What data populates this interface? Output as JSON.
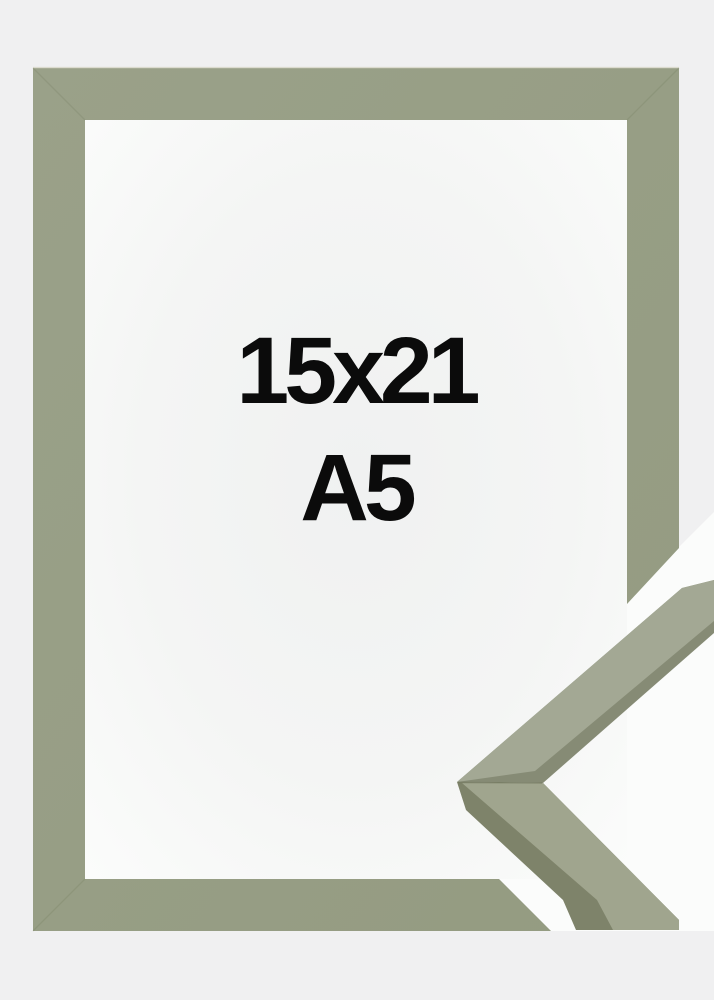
{
  "size_label": {
    "line1": "15x21",
    "line2": "A5"
  },
  "colors": {
    "background": "#f0f0f1",
    "frame_light": "#9aa189",
    "frame_dark": "#949b81",
    "frame_edge_highlight": "#d8d7c9",
    "frame_seam": "#6f7558",
    "window_center": "#f0f1f1",
    "window_mid": "#f4f5f4",
    "window_edge": "#fbfcfb",
    "cutout_white": "#fbfcfb",
    "detail_face_upper": "#a3a894",
    "detail_face_lower": "#a0a58e",
    "detail_side_upper": "#868b75",
    "detail_side_lower": "#7e836a",
    "detail_seam": "#6e745a",
    "label_text": "#0b0b0b"
  }
}
